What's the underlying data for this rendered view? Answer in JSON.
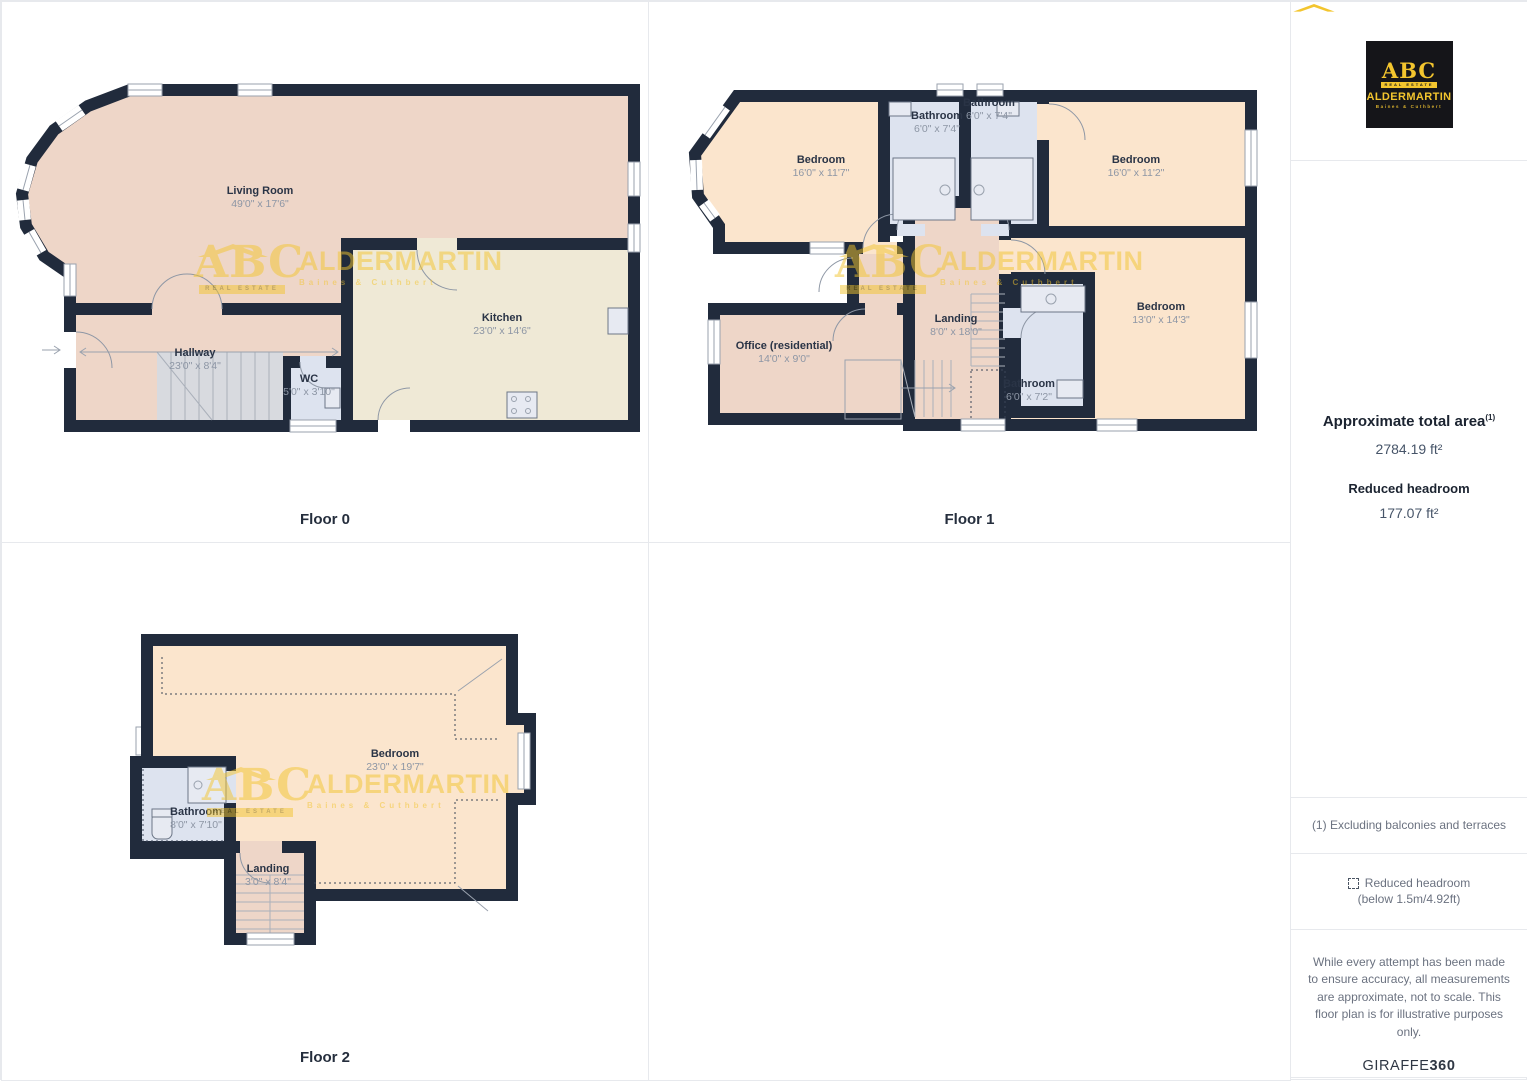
{
  "floors": {
    "floor0": {
      "title": "Floor 0",
      "rooms": {
        "living": {
          "name": "Living Room",
          "dims": "49'0\" x 17'6\""
        },
        "kitchen": {
          "name": "Kitchen",
          "dims": "23'0\" x 14'6\""
        },
        "hallway": {
          "name": "Hallway",
          "dims": "23'0\" x 8'4\""
        },
        "wc": {
          "name": "WC",
          "dims": "5'0\" x 3'10\""
        }
      }
    },
    "floor1": {
      "title": "Floor 1",
      "rooms": {
        "bed_tl": {
          "name": "Bedroom",
          "dims": "16'0\" x 11'7\""
        },
        "bath_tl": {
          "name": "Bathroom",
          "dims": "6'0\" x 7'4\""
        },
        "bath_tr": {
          "name": "Bathroom",
          "dims": "6'0\" x 7'4\""
        },
        "bed_tr": {
          "name": "Bedroom",
          "dims": "16'0\" x 11'2\""
        },
        "bed_br": {
          "name": "Bedroom",
          "dims": "13'0\" x 14'3\""
        },
        "landing": {
          "name": "Landing",
          "dims": "8'0\" x 18'0\""
        },
        "office": {
          "name": "Office (residential)",
          "dims": "14'0\" x 9'0\""
        },
        "bath_b": {
          "name": "Bathroom",
          "dims": "6'0\" x 7'2\""
        }
      }
    },
    "floor2": {
      "title": "Floor 2",
      "rooms": {
        "bedroom": {
          "name": "Bedroom",
          "dims": "23'0\" x 19'7\""
        },
        "bathroom": {
          "name": "Bathroom",
          "dims": "8'0\" x 7'10\""
        },
        "landing": {
          "name": "Landing",
          "dims": "3'0\" x 8'4\""
        }
      }
    }
  },
  "sidebar": {
    "area_title": "Approximate total area",
    "area_footnote_marker": "(1)",
    "area_value": "2784.19 ft²",
    "headroom_title": "Reduced headroom",
    "headroom_value": "177.07 ft²",
    "footnote": "(1) Excluding balconies and terraces",
    "legend_line1": "Reduced headroom",
    "legend_line2": "(below 1.5m/4.92ft)",
    "disclaimer": "While every attempt has been made to ensure accuracy, all measurements are approximate, not to scale. This floor plan is for illustrative purposes only.",
    "brand_name": "GIRAFFE",
    "brand_number": "360"
  },
  "brand": {
    "logo_abc": "ABC",
    "logo_tagline": "REAL ESTATE",
    "logo_name": "ALDERMARTIN",
    "logo_sub": "Baines & Cuthbert"
  },
  "colors": {
    "wall": "#212b3c",
    "living_pink": "#eed6c8",
    "kitchen_cream": "#efe9d6",
    "bedroom_peach": "#fbe5cd",
    "bathroom_blue": "#dde3ef",
    "brand_yellow": "#f3c52e"
  }
}
